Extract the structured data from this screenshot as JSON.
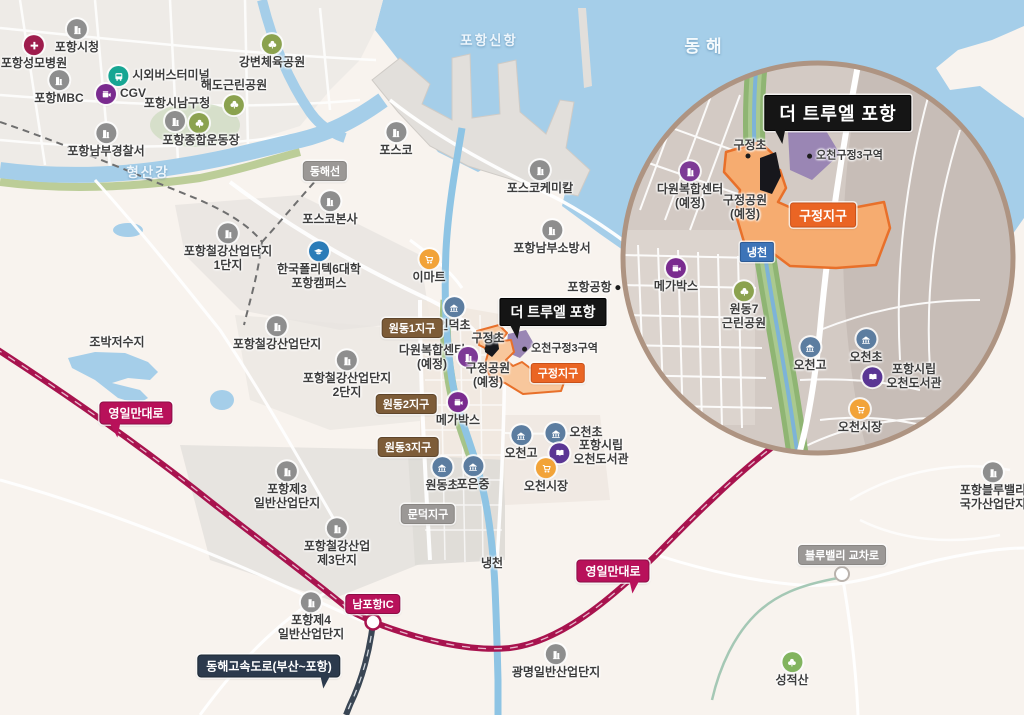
{
  "colors": {
    "sea": "#a5cee9",
    "land": "#f8f3ee",
    "road_magenta": "#b8115a",
    "expressway_navy": "#2c3a4d",
    "zone_orange_fill": "#f6ac70",
    "zone_orange_border": "#e8702a",
    "zone_purple": "#9a86b4",
    "badge_black": "#151515",
    "badge_brown": "#7d5c38",
    "badge_gray": "#9b9896",
    "badge_blue": "#3d74b8"
  },
  "markers": [
    {
      "n": "pohang-city-hall",
      "t": "포항시청",
      "x": 77,
      "y": 37,
      "ic": "building",
      "lp": "b"
    },
    {
      "n": "pohang-st-marys-hospital",
      "t": "포항성모병원",
      "x": 34,
      "y": 53,
      "ic": "hospital",
      "lp": "b"
    },
    {
      "n": "intercity-bus-terminal",
      "t": "시외버스터미널",
      "x": 159,
      "y": 76,
      "ic": "bus",
      "lp": "r"
    },
    {
      "n": "pohang-mbc",
      "t": "포항MBC",
      "x": 59,
      "y": 88,
      "ic": "building",
      "lp": "b"
    },
    {
      "n": "cgv",
      "t": "CGV",
      "x": 121,
      "y": 94,
      "ic": "cinema",
      "lp": "r"
    },
    {
      "n": "pohang-namgu-office",
      "t": "포항시남구청",
      "x": 177,
      "y": 104,
      "lp": "n"
    },
    {
      "n": "stadium-building-icon",
      "t": "",
      "x": 175,
      "y": 121,
      "ic": "building",
      "lp": "i"
    },
    {
      "n": "stadium-park-icon",
      "t": "",
      "x": 199,
      "y": 123,
      "ic": "park",
      "lp": "i"
    },
    {
      "n": "pohang-sports-complex",
      "t": "포항종합운동장",
      "x": 201,
      "y": 141,
      "lp": "n"
    },
    {
      "n": "haedo-park",
      "t": "해도근린공원",
      "x": 234,
      "y": 97,
      "ic": "park",
      "lp": "bt"
    },
    {
      "n": "gangbyeon-sports-park",
      "t": "강변체육공원",
      "x": 272,
      "y": 52,
      "ic": "park",
      "lp": "b"
    },
    {
      "n": "pohang-nambu-police",
      "t": "포항남부경찰서",
      "x": 106,
      "y": 141,
      "ic": "building",
      "lp": "b"
    },
    {
      "n": "posco",
      "t": "포스코",
      "x": 396,
      "y": 140,
      "ic": "building",
      "lp": "b"
    },
    {
      "n": "posco-hq",
      "t": "포스코본사",
      "x": 330,
      "y": 209,
      "ic": "building",
      "lp": "b"
    },
    {
      "n": "korea-polytechnic-campus",
      "t": "한국폴리텍6대학\n포항캠퍼스",
      "x": 319,
      "y": 266,
      "ic": "college",
      "lp": "b"
    },
    {
      "n": "steel-industrial-complex-1",
      "t": "포항철강산업단지\n1단지",
      "x": 228,
      "y": 248,
      "ic": "building",
      "lp": "b"
    },
    {
      "n": "steel-industrial-complex",
      "t": "포항철강산업단지",
      "x": 277,
      "y": 334,
      "ic": "building",
      "lp": "b"
    },
    {
      "n": "steel-industrial-complex-2",
      "t": "포항철강산업단지\n2단지",
      "x": 347,
      "y": 375,
      "ic": "building",
      "lp": "b"
    },
    {
      "n": "jobak-reservoir",
      "t": "조박저수지",
      "x": 117,
      "y": 343,
      "lp": "n"
    },
    {
      "n": "emart",
      "t": "이마트",
      "x": 429,
      "y": 267,
      "ic": "cart",
      "lp": "b"
    },
    {
      "n": "indeok-elementary",
      "t": "인덕초",
      "x": 454,
      "y": 315,
      "ic": "school",
      "lp": "b"
    },
    {
      "n": "dawon-complex-main",
      "t": "다원복합센터\n(예정)",
      "x": 432,
      "y": 358,
      "lp": "n"
    },
    {
      "n": "dawon-complex-icon-main",
      "t": "",
      "x": 468,
      "y": 357,
      "ic": "building2",
      "lp": "i"
    },
    {
      "n": "gujeong-elementary-main",
      "t": "구정초",
      "x": 488,
      "y": 339,
      "lp": "n"
    },
    {
      "n": "gujeong-elementary-dot-main",
      "t": "",
      "x": 487,
      "y": 349,
      "lp": "dot"
    },
    {
      "n": "ocheon-gujeong3-zone-main",
      "t": "오천구정3구역",
      "x": 560,
      "y": 349,
      "lp": "dr",
      "cls": "sm"
    },
    {
      "n": "gujeong-park-main",
      "t": "구정공원\n(예정)",
      "x": 488,
      "y": 376,
      "lp": "n"
    },
    {
      "n": "megabox-main",
      "t": "메가박스",
      "x": 458,
      "y": 410,
      "ic": "cinema",
      "lp": "b"
    },
    {
      "n": "pohang-nambu-fire-station",
      "t": "포항남부소방서",
      "x": 552,
      "y": 238,
      "ic": "building",
      "lp": "b"
    },
    {
      "n": "posco-chemical",
      "t": "포스코케미칼",
      "x": 540,
      "y": 178,
      "ic": "building",
      "lp": "b"
    },
    {
      "n": "pohang-airport",
      "t": "포항공항",
      "x": 594,
      "y": 288,
      "lp": "ld"
    },
    {
      "n": "ocheon-high-main",
      "t": "오천고",
      "x": 521,
      "y": 443,
      "ic": "school",
      "lp": "b"
    },
    {
      "n": "ocheon-elementary-main",
      "t": "오천초",
      "x": 574,
      "y": 433,
      "ic": "school",
      "lp": "r"
    },
    {
      "n": "ocheon-library-main",
      "t": "포항시립\n오천도서관",
      "x": 589,
      "y": 453,
      "ic": "library",
      "lp": "r"
    },
    {
      "n": "ocheon-market-main",
      "t": "오천시장",
      "x": 546,
      "y": 476,
      "ic": "cart",
      "lp": "b"
    },
    {
      "n": "wondong-elementary",
      "t": "원동초",
      "x": 442,
      "y": 475,
      "ic": "school",
      "lp": "b"
    },
    {
      "n": "poeun-middle",
      "t": "포은중",
      "x": 473,
      "y": 474,
      "ic": "school",
      "lp": "b"
    },
    {
      "n": "naengcheon-river-label",
      "t": "냉천",
      "x": 492,
      "y": 564,
      "lp": "n"
    },
    {
      "n": "pohang-3rd-general-industrial",
      "t": "포항제3\n일반산업단지",
      "x": 287,
      "y": 486,
      "ic": "building",
      "lp": "b"
    },
    {
      "n": "steel-3rd-complex",
      "t": "포항철강산업\n제3단지",
      "x": 337,
      "y": 543,
      "ic": "building",
      "lp": "b"
    },
    {
      "n": "pohang-4th-general-industrial",
      "t": "포항제4\n일반산업단지",
      "x": 311,
      "y": 617,
      "ic": "building",
      "lp": "b"
    },
    {
      "n": "gwangmyeong-industrial",
      "t": "광명일반산업단지",
      "x": 556,
      "y": 662,
      "ic": "building",
      "lp": "b"
    },
    {
      "n": "seongjeoksan-mountain",
      "t": "성적산",
      "x": 792,
      "y": 670,
      "ic": "mountain",
      "lp": "b"
    },
    {
      "n": "pohang-bluevalley-industrial",
      "t": "포항블루밸리\n국가산업단지",
      "x": 993,
      "y": 487,
      "ic": "building",
      "lp": "b"
    },
    {
      "n": "donghae-sea-label",
      "t": "동해",
      "x": 706,
      "y": 47,
      "lp": "n",
      "cls": "seaXL"
    },
    {
      "n": "pohang-new-port-label",
      "t": "포항신항",
      "x": 489,
      "y": 41,
      "lp": "n",
      "cls": "sea"
    },
    {
      "n": "hyeongsan-river-label",
      "t": "형산강",
      "x": 148,
      "y": 173,
      "lp": "n",
      "cls": "sea"
    },
    {
      "n": "gujeong-elementary-inset",
      "t": "구정초",
      "x": 750,
      "y": 146,
      "lp": "n"
    },
    {
      "n": "gujeong-elementary-dot-inset",
      "t": "",
      "x": 748,
      "y": 156,
      "lp": "dot"
    },
    {
      "n": "ocheon-gujeong3-zone-inset",
      "t": "오천구정3구역",
      "x": 845,
      "y": 156,
      "lp": "dr",
      "cls": "sm"
    },
    {
      "n": "dawon-complex-inset",
      "t": "다원복합센터\n(예정)",
      "x": 690,
      "y": 186,
      "ic": "building2",
      "lp": "b"
    },
    {
      "n": "gujeong-park-inset",
      "t": "구정공원\n(예정)",
      "x": 745,
      "y": 208,
      "lp": "n"
    },
    {
      "n": "megabox-inset",
      "t": "메가박스",
      "x": 676,
      "y": 276,
      "ic": "cinema",
      "lp": "b"
    },
    {
      "n": "wondong7-park-inset",
      "t": "원동7\n근린공원",
      "x": 744,
      "y": 306,
      "ic": "park",
      "lp": "b"
    },
    {
      "n": "ocheon-high-inset",
      "t": "오천고",
      "x": 810,
      "y": 355,
      "ic": "school",
      "lp": "b"
    },
    {
      "n": "ocheon-elementary-inset",
      "t": "오천초",
      "x": 866,
      "y": 347,
      "ic": "school",
      "lp": "b"
    },
    {
      "n": "ocheon-library-inset",
      "t": "포항시립\n오천도서관",
      "x": 902,
      "y": 377,
      "ic": "library",
      "lp": "r"
    },
    {
      "n": "ocheon-market-inset",
      "t": "오천시장",
      "x": 860,
      "y": 417,
      "ic": "cart",
      "lp": "b"
    }
  ],
  "badges": [
    {
      "n": "donghae-line-badge",
      "t": "동해선",
      "x": 325,
      "y": 171,
      "cls": "gray sm"
    },
    {
      "n": "wondong1-district-badge",
      "t": "원동1지구",
      "x": 412,
      "y": 328,
      "cls": "brown sm"
    },
    {
      "n": "wondong2-district-badge",
      "t": "원동2지구",
      "x": 406,
      "y": 404,
      "cls": "brown sm"
    },
    {
      "n": "wondong3-district-badge",
      "t": "원동3지구",
      "x": 408,
      "y": 447,
      "cls": "brown sm"
    },
    {
      "n": "mundeok-district-badge",
      "t": "문덕지구",
      "x": 428,
      "y": 514,
      "cls": "gray sm"
    },
    {
      "n": "yeongilman-road-badge-left",
      "t": "영일만대로",
      "x": 136,
      "y": 413,
      "cls": "magenta t-bl"
    },
    {
      "n": "yeongilman-road-badge-right",
      "t": "영일만대로",
      "x": 613,
      "y": 571,
      "cls": "magenta t-br"
    },
    {
      "n": "nampohang-ic-badge",
      "t": "남포항IC",
      "x": 373,
      "y": 604,
      "cls": "magenta sm"
    },
    {
      "n": "donghae-expressway-badge",
      "t": "동해고속도로(부산~포항)",
      "x": 269,
      "y": 666,
      "cls": "navy t-br"
    },
    {
      "n": "bluevalley-junction-badge",
      "t": "블루밸리 교차로",
      "x": 842,
      "y": 555,
      "cls": "gray sm"
    },
    {
      "n": "truel-pohang-badge-main",
      "t": "더 트루엘 포항",
      "x": 553,
      "y": 312,
      "cls": "black t-bl"
    },
    {
      "n": "truel-pohang-badge-inset",
      "t": "더 트루엘 포항",
      "x": 838,
      "y": 113,
      "cls": "black lg2 t-bl"
    },
    {
      "n": "gujeong-district-badge-main",
      "t": "구정지구",
      "x": 558,
      "y": 373,
      "cls": "orangeb sm"
    },
    {
      "n": "gujeong-district-badge-inset",
      "t": "구정지구",
      "x": 823,
      "y": 215,
      "cls": "orangeb md2"
    },
    {
      "n": "naengcheon-badge-inset",
      "t": "냉천",
      "x": 757,
      "y": 252,
      "cls": "blueb sm"
    }
  ]
}
